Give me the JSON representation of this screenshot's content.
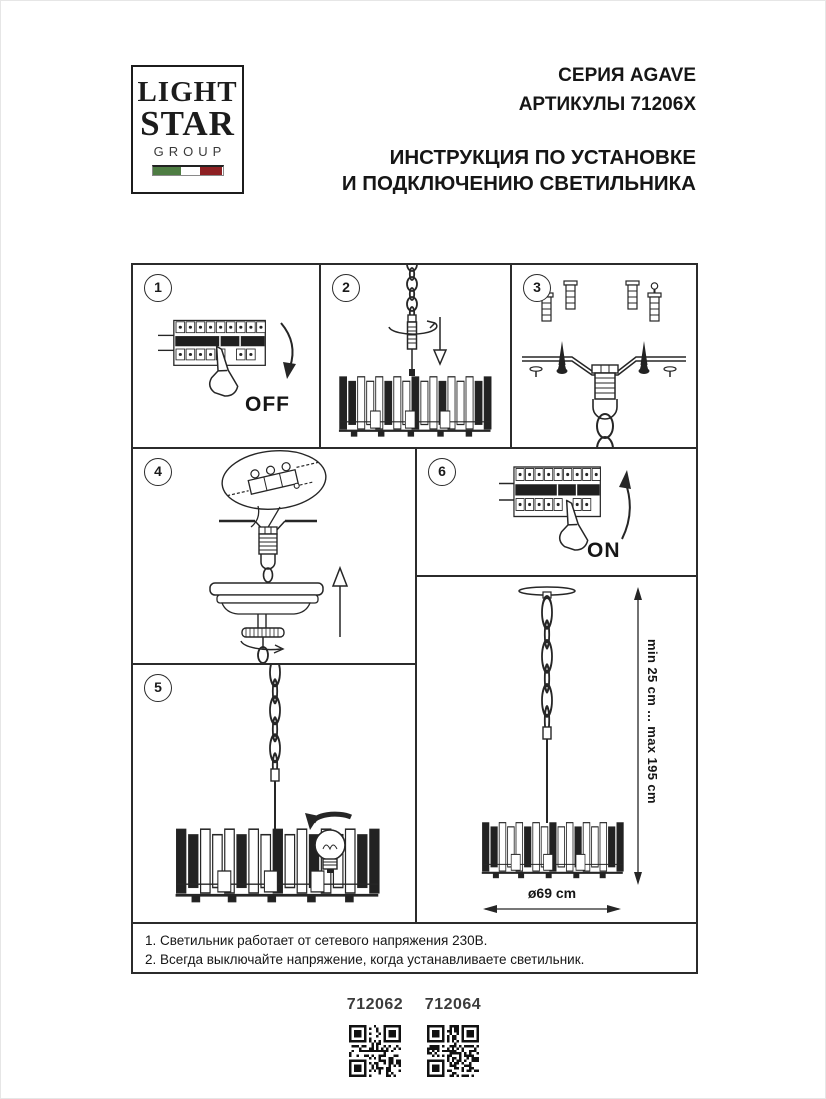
{
  "logo": {
    "line1": "LIGHT",
    "line2": "STAR",
    "line3": "GROUP",
    "flag_green": "#4e7d43",
    "flag_white": "#ffffff",
    "flag_red": "#8e2023"
  },
  "header": {
    "series": "СЕРИЯ AGAVE",
    "articles": "АРТИКУЛЫ 71206X",
    "instruction_line1": "ИНСТРУКЦИЯ ПО УСТАНОВКЕ",
    "instruction_line2": "И ПОДКЛЮЧЕНИЮ СВЕТИЛЬНИКА"
  },
  "panels": {
    "p1": {
      "number": "1",
      "label": "OFF"
    },
    "p2": {
      "number": "2"
    },
    "p3": {
      "number": "3"
    },
    "p4": {
      "number": "4"
    },
    "p5": {
      "number": "5"
    },
    "p6": {
      "number": "6",
      "label": "ON"
    }
  },
  "dimensions": {
    "height_range": "min 25 cm ... max 195 cm",
    "diameter": "ø69 cm"
  },
  "notes": [
    "1. Светильник работает от сетевого напряжения 230В.",
    "2. Всегда выключайте напряжение, когда устанавливаете светильник."
  ],
  "footer": {
    "articles": [
      {
        "code": "712062"
      },
      {
        "code": "712064"
      }
    ]
  },
  "colors": {
    "line": "#262626"
  }
}
